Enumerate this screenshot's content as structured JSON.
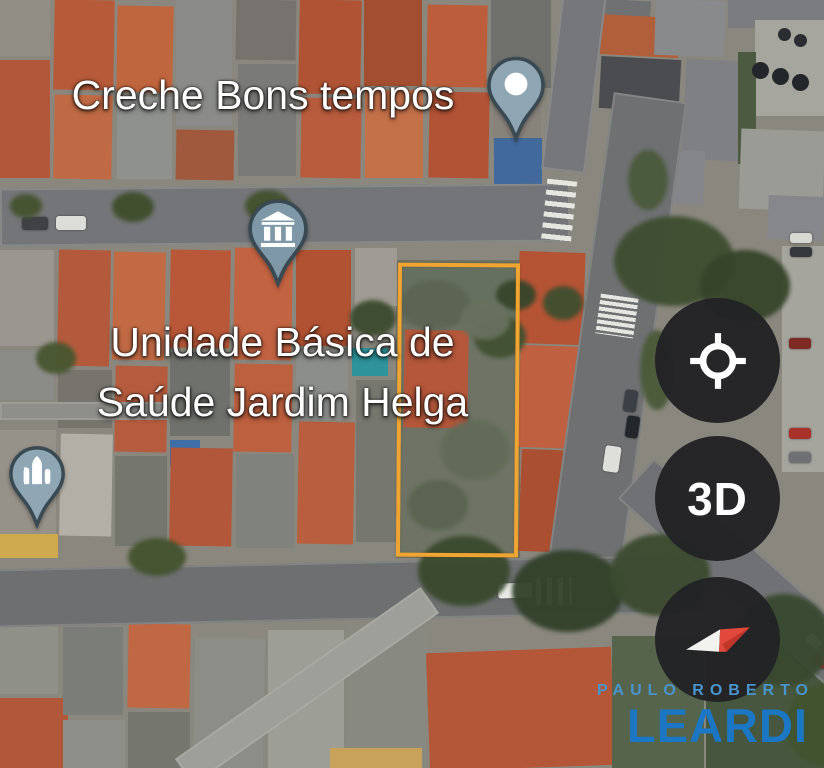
{
  "map": {
    "type": "satellite-aerial-view",
    "labels": {
      "creche": "Creche Bons tempos",
      "ubs_line1": "Unidade Básica de",
      "ubs_line2": "Saúde Jardim Helga"
    },
    "pins": [
      {
        "name": "creche-place-pin",
        "icon": "white-dot"
      },
      {
        "name": "health-facility-pin",
        "icon": "civic-building"
      },
      {
        "name": "church-pin",
        "icon": "church"
      }
    ],
    "highlight": {
      "description": "outlined vacant lot",
      "color": "#F0A432"
    }
  },
  "controls": {
    "buttons": [
      {
        "name": "my-location",
        "icon": "crosshair"
      },
      {
        "name": "3d-view",
        "label": "3D"
      },
      {
        "name": "compass",
        "icon": "compass-needle"
      }
    ],
    "button_bg": "#222225",
    "compass_red": "#DA4336",
    "compass_white": "#F2F2EF"
  },
  "watermark": {
    "line1": "PAULO ROBERTO",
    "line2": "LEARDI",
    "color_line1": "#4A94CD",
    "color_line2": "#1B77C4"
  },
  "colors": {
    "pin_fill": "#8FA6B5",
    "pin_fill_dark": "#7E98A8",
    "pin_stroke": "#3A4A52",
    "label_text": "#FFFFFF",
    "highlight": "#F0A432"
  }
}
